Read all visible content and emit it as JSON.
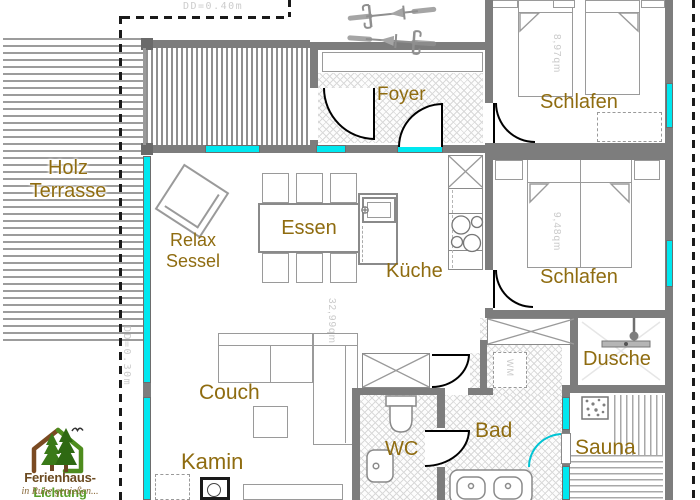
{
  "plan": {
    "annotations": {
      "overhang_top": "DD=0.40m",
      "overhang_left": "DD=0.30m"
    },
    "rooms": {
      "terrace": {
        "line1": "Holz",
        "line2": "Terrasse"
      },
      "relax": {
        "line1": "Relax",
        "line2": "Sessel"
      },
      "foyer": {
        "label": "Foyer"
      },
      "bedroom_top": {
        "label": "Schlafen",
        "area": "8,97qm"
      },
      "bedroom_mid": {
        "label": "Schlafen",
        "area": "9,48qm"
      },
      "dining": {
        "label": "Essen"
      },
      "kitchen": {
        "label": "Küche"
      },
      "living": {
        "area": "32,99qm"
      },
      "couch": {
        "label": "Couch"
      },
      "fireplace": {
        "label": "Kamin"
      },
      "wc": {
        "label": "WC"
      },
      "bath": {
        "label": "Bad",
        "washer": "WM"
      },
      "shower": {
        "label": "Dusche"
      },
      "sauna": {
        "label": "Sauna"
      }
    },
    "colors": {
      "glass": "#00e8f0",
      "wall": "#7d7d7d",
      "label": "#8f6c10"
    }
  },
  "logo": {
    "brand_brown": "Ferienhaus-",
    "brand_green": "Lichtung",
    "tagline": "in Ruhe genießen..."
  }
}
